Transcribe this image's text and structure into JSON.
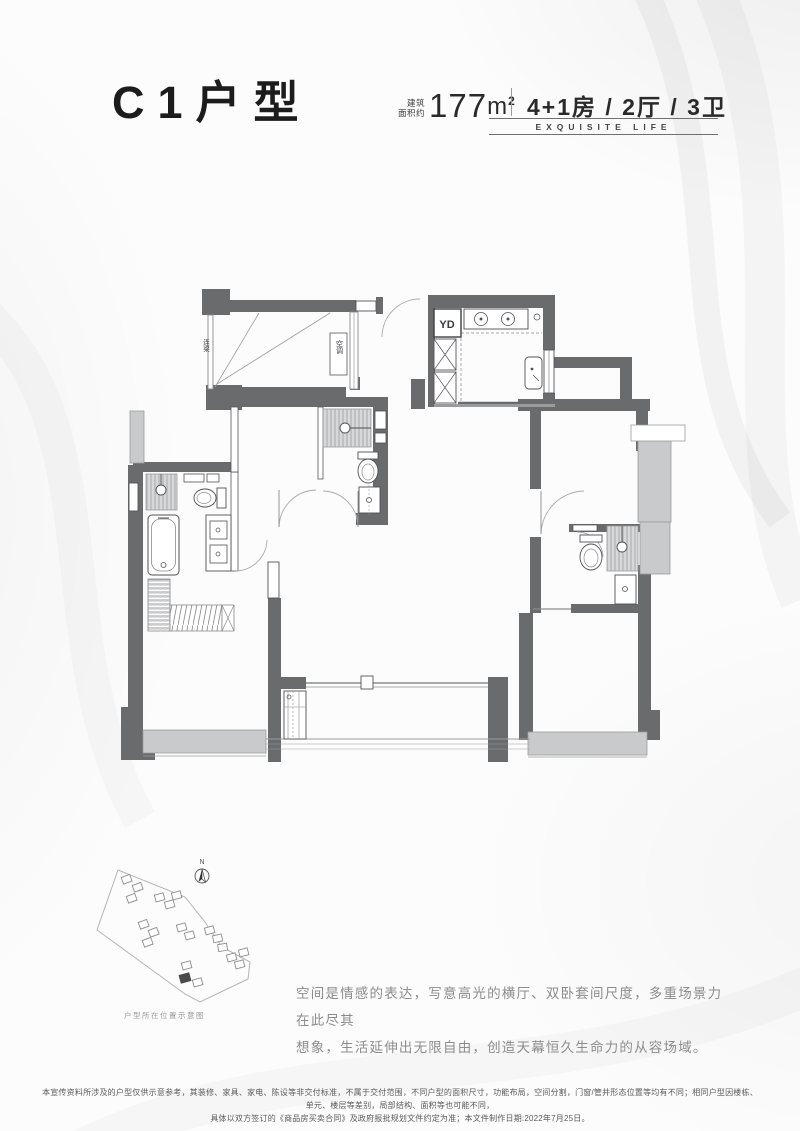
{
  "header": {
    "title": "C1户型",
    "area_label_top": "建筑",
    "area_label_bottom": "面积约",
    "area_value": "177",
    "area_unit": "m",
    "area_superscript": "2",
    "spec": "4+1房 / 2厅 / 3卫",
    "tagline": "EXQUISITE LIFE"
  },
  "floor_plan": {
    "labels": {
      "beam": "连梁",
      "ac": "空调",
      "flue": "YD"
    }
  },
  "site_map": {
    "north": "N",
    "caption": "户型所在位置示意图"
  },
  "description": {
    "line1": "空间是情感的表达，写意高光的横厅、双卧套间尺度，多重场景力在此尽其",
    "line2": "想象，生活延伸出无限自由，创造天幕恒久生命力的从容场域。"
  },
  "disclaimer": {
    "line1": "本宣传资料所涉及的户型仅供示意参考，其装修、家具、家电、陈设等非交付标准，不属于交付范围，不同户型的面积尺寸，功能布局，空间分割，门窗/管井形态位置等均有不同；相同户型因楼栋、单元、楼层等差别，局部结构、面积等也可能不同，",
    "line2": "具体以双方签订的《商品房买卖合同》及政府报批规划文件约定为准；本文件制作日期:2022年7月25日。"
  },
  "colors": {
    "wall": "#6a6b6d",
    "slab": "#c9cacb",
    "title_text": "#1c1c1c",
    "muted_text": "#8c8c8c"
  }
}
